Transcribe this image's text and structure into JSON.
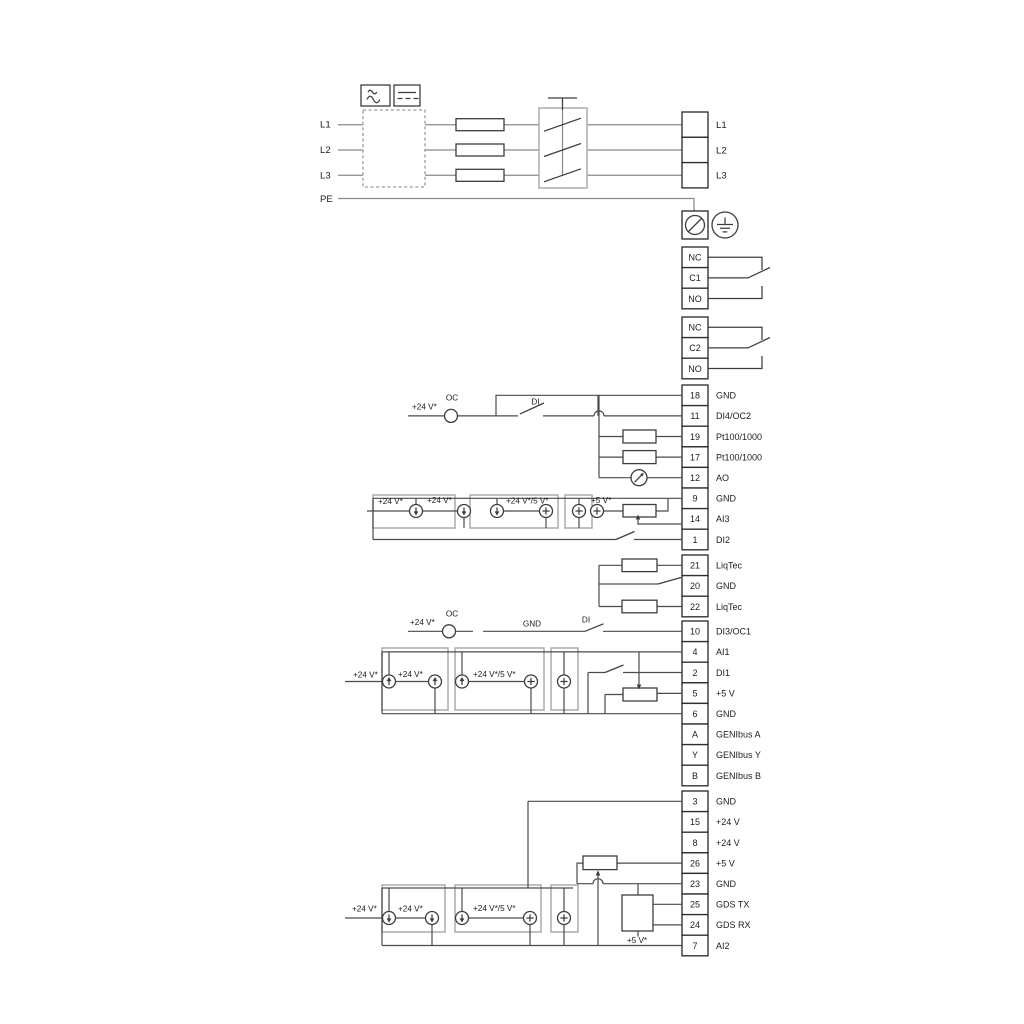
{
  "power": {
    "inputs": [
      "L1",
      "L2",
      "L3",
      "PE"
    ],
    "outputs": [
      "L1",
      "L2",
      "L3"
    ]
  },
  "relays": {
    "r1": [
      "NC",
      "C1",
      "NO"
    ],
    "r2": [
      "NC",
      "C2",
      "NO"
    ]
  },
  "terminals": {
    "g1": [
      {
        "num": "18",
        "label": "GND"
      },
      {
        "num": "11",
        "label": "DI4/OC2"
      },
      {
        "num": "19",
        "label": "Pt100/1000"
      },
      {
        "num": "17",
        "label": "Pt100/1000"
      },
      {
        "num": "12",
        "label": "AO"
      },
      {
        "num": "9",
        "label": "GND"
      },
      {
        "num": "14",
        "label": "AI3"
      },
      {
        "num": "1",
        "label": "DI2"
      }
    ],
    "g2": [
      {
        "num": "21",
        "label": "LiqTec"
      },
      {
        "num": "20",
        "label": "GND"
      },
      {
        "num": "22",
        "label": "LiqTec"
      }
    ],
    "g3": [
      {
        "num": "10",
        "label": "DI3/OC1"
      },
      {
        "num": "4",
        "label": "AI1"
      },
      {
        "num": "2",
        "label": "DI1"
      },
      {
        "num": "5",
        "label": "+5 V"
      },
      {
        "num": "6",
        "label": "GND"
      },
      {
        "num": "A",
        "label": "GENIbus A"
      },
      {
        "num": "Y",
        "label": "GENIbus Y"
      },
      {
        "num": "B",
        "label": "GENIbus B"
      }
    ],
    "g4": [
      {
        "num": "3",
        "label": "GND"
      },
      {
        "num": "15",
        "label": "+24 V"
      },
      {
        "num": "8",
        "label": "+24 V"
      },
      {
        "num": "26",
        "label": "+5 V"
      },
      {
        "num": "23",
        "label": "GND"
      },
      {
        "num": "25",
        "label": "GDS TX"
      },
      {
        "num": "24",
        "label": "GDS RX"
      },
      {
        "num": "7",
        "label": "AI2"
      }
    ]
  },
  "labels": {
    "v24": "+24 V*",
    "v24or5": "+24 V*/5 V*",
    "v5": "+5 V*",
    "oc": "OC",
    "di": "DI",
    "gnd": "GND"
  },
  "colors": {
    "wire_gray": "#8a8a8a",
    "wire_dark": "#4a4a4a",
    "enclosure_gray": "#ababab",
    "outline_dark": "#2e2e2e",
    "text": "#1c1c1c"
  }
}
